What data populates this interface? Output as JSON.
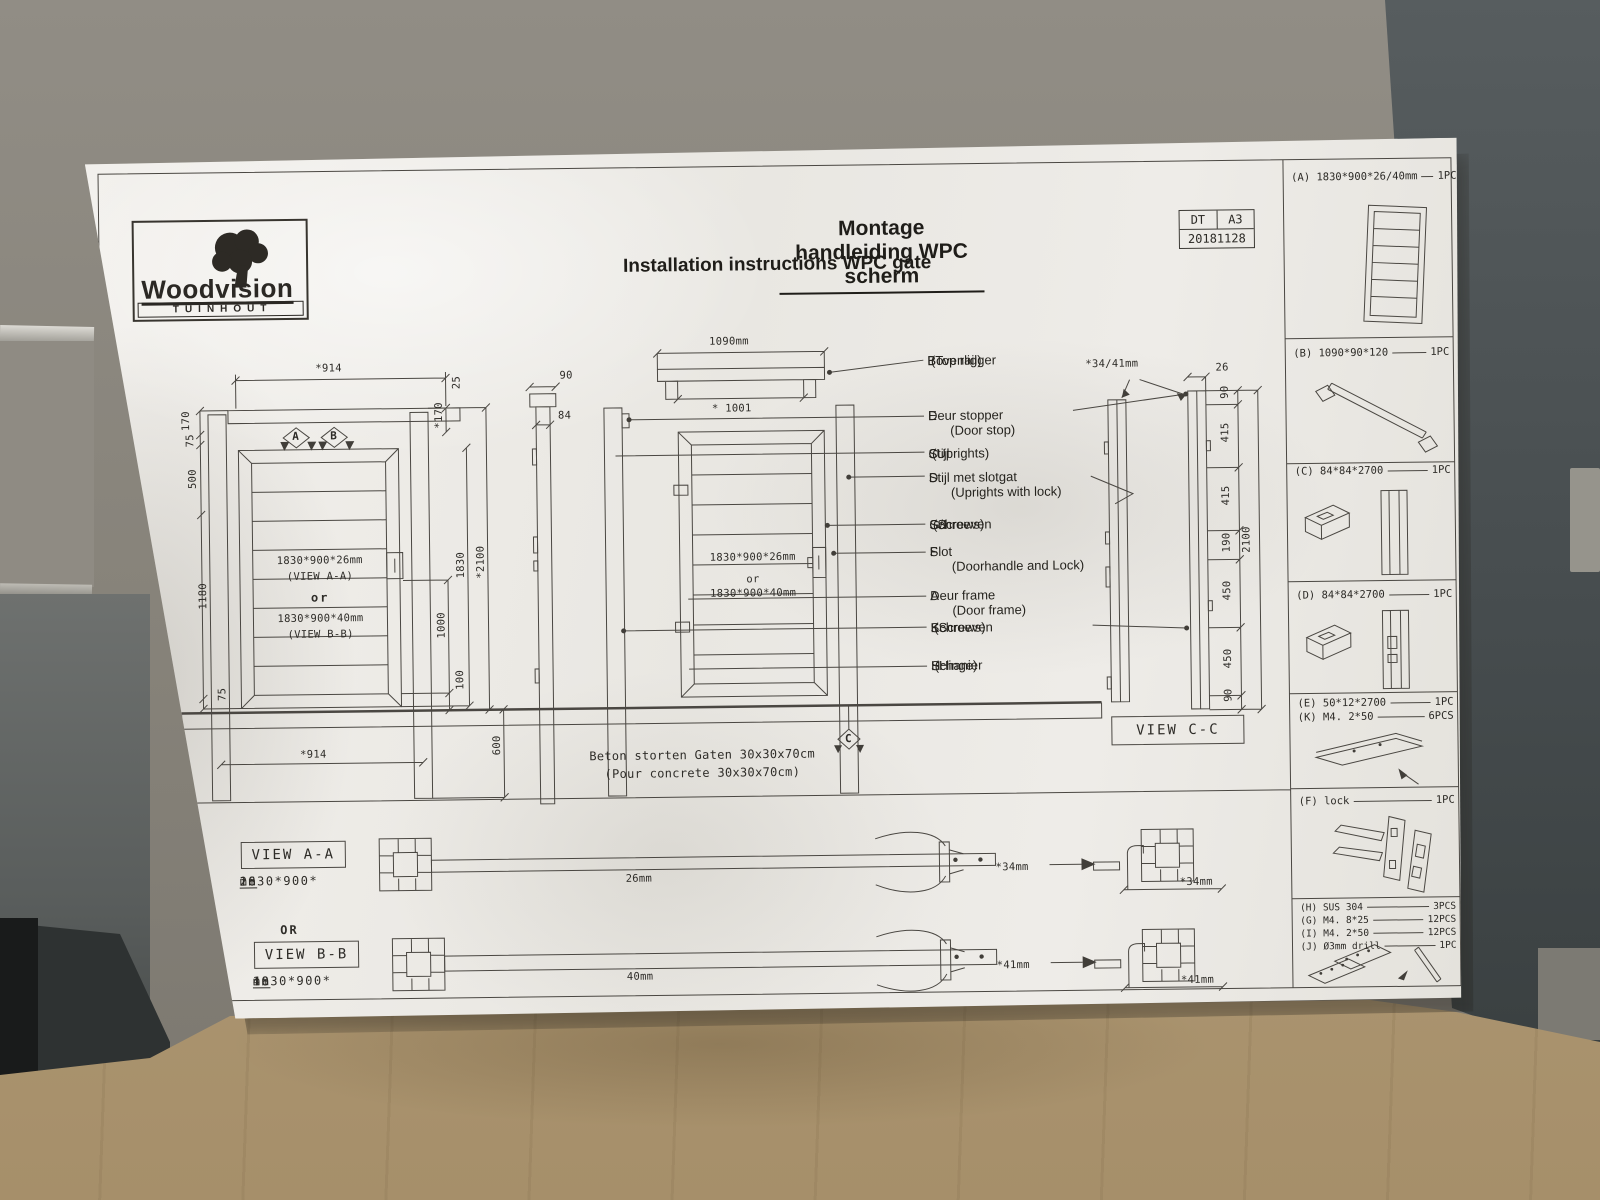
{
  "colors": {
    "paper": "#efede9",
    "wall": "#868279",
    "panel": "#474d4f",
    "cardboard": "#b29c77",
    "line": "#4a4742"
  },
  "logo": {
    "brand": "Woodvision",
    "tagline": "TUINHOUT"
  },
  "title": {
    "nl": "Montage handleiding WPC scherm",
    "en": "Installation instructions WPC gate"
  },
  "titleblock": {
    "code": "DT",
    "sheet": "A3",
    "date": "20181128"
  },
  "parts": [
    {
      "label": "(A) 1830*900*26/40mm",
      "qty": "1PC"
    },
    {
      "label": "(B) 1090*90*120",
      "qty": "1PC"
    },
    {
      "label": "(C) 84*84*2700",
      "qty": "1PC"
    },
    {
      "label": "(D) 84*84*2700",
      "qty": "1PC"
    },
    {
      "label": "(E) 50*12*2700",
      "qty": "1PC"
    },
    {
      "label": "(K) M4. 2*50",
      "qty": "6PCS"
    },
    {
      "label": "(F) lock",
      "qty": "1PC"
    },
    {
      "label": "(H) SUS 304",
      "qty": "3PCS"
    },
    {
      "label": "(G) M4. 8*25",
      "qty": "12PCS"
    },
    {
      "label": "(I) M4. 2*50",
      "qty": "12PCS"
    },
    {
      "label": "(J) Ø3mm drill",
      "qty": "1PC"
    }
  ],
  "callouts": [
    {
      "key": "B",
      "nl": "Bovenligger",
      "en": "(Top rail)"
    },
    {
      "key": "E",
      "nl": "Deur stopper",
      "en": "(Door stop)"
    },
    {
      "key": "C",
      "nl": "Stijl",
      "en": "(Uprights)"
    },
    {
      "key": "D",
      "nl": "Stijl met slotgat",
      "en": "(Uprights with lock)"
    },
    {
      "key": "G/I",
      "nl": "Schroeven",
      "en": "(Screws)"
    },
    {
      "key": "F",
      "nl": "Slot",
      "en": "(Doorhandle and Lock)"
    },
    {
      "key": "A",
      "nl": "Deur frame",
      "en": "(Door frame)"
    },
    {
      "key": "K",
      "nl": "Schroeven",
      "en": "(Screws)"
    },
    {
      "key": "H",
      "nl": "Schanier",
      "en": "(Hinge)"
    }
  ],
  "markers": {
    "a": "A",
    "b": "B",
    "c": "C"
  },
  "dims": {
    "w914": "*914",
    "n25": "25",
    "n170": "170",
    "n75": "75",
    "n500": "500",
    "n1180": "1180",
    "r170": "*170",
    "n1830": "1830",
    "r2100": "*2100",
    "n1000": "1000",
    "n100": "100",
    "n600": "600",
    "n90": "90",
    "n84": "84",
    "rail": "1090mm",
    "rail_inner": "* 1001",
    "gap": "*34/41mm",
    "n26": "26",
    "n415": "415",
    "n190": "190",
    "n2100": "2100",
    "n450": "450",
    "t26": "26mm",
    "t40": "40mm",
    "t34": "*34mm",
    "t41": "*41mm"
  },
  "door_text": {
    "s26": "1830*900*26mm",
    "vaa": "(VIEW A-A)",
    "or": "or",
    "s40": "1830*900*40mm",
    "vbb": "(VIEW B-B)"
  },
  "views": {
    "aa": "VIEW A-A",
    "bb": "VIEW B-B",
    "cc": "VIEW C-C",
    "or": "OR",
    "aa_pre": "1830*900*",
    "aa_key": "26",
    "aa_suf": "mm",
    "bb_pre": "1830*900*",
    "bb_key": "40",
    "bb_suf": "mm"
  },
  "note": {
    "nl": "Beton storten Gaten 30x30x70cm",
    "en": "(Pour concrete  30x30x70cm)"
  }
}
